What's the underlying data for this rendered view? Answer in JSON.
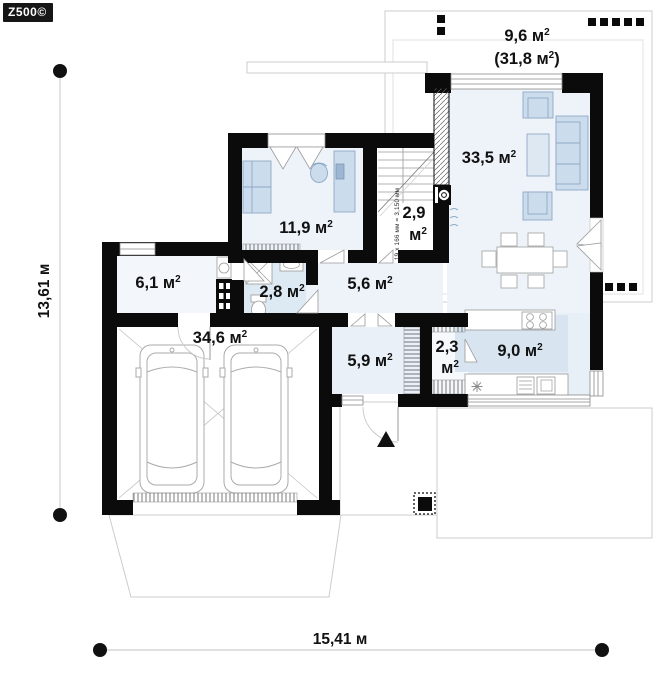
{
  "brand": {
    "logo_text": "Z500©"
  },
  "plan": {
    "dimensions": {
      "width_label": "15,41 м",
      "height_label": "13,61 м"
    },
    "stairs_note": "19 x 166 мм = 3,150 мм",
    "terrace": {
      "area": "9,6 м",
      "area_sup": "2",
      "total_pre": "(31,8 м",
      "total_sup": "2",
      "total_post": ")"
    },
    "rooms": {
      "living": {
        "label": "33,5 м",
        "sup": "2"
      },
      "office": {
        "label": "11,9 м",
        "sup": "2"
      },
      "closet": {
        "line1": "2,9",
        "line2": "м",
        "sup": "2"
      },
      "hall": {
        "label": "5,6 м",
        "sup": "2"
      },
      "bathroom": {
        "label": "2,8 м",
        "sup": "2"
      },
      "entry": {
        "label": "6,1 м",
        "sup": "2"
      },
      "garage": {
        "label": "34,6 м",
        "sup": "2"
      },
      "mudroom": {
        "label": "5,9 м",
        "sup": "2"
      },
      "pantry": {
        "line1": "2,3",
        "line2": "м",
        "sup": "2"
      },
      "kitchen": {
        "label": "9,0 м",
        "sup": "2"
      }
    }
  }
}
